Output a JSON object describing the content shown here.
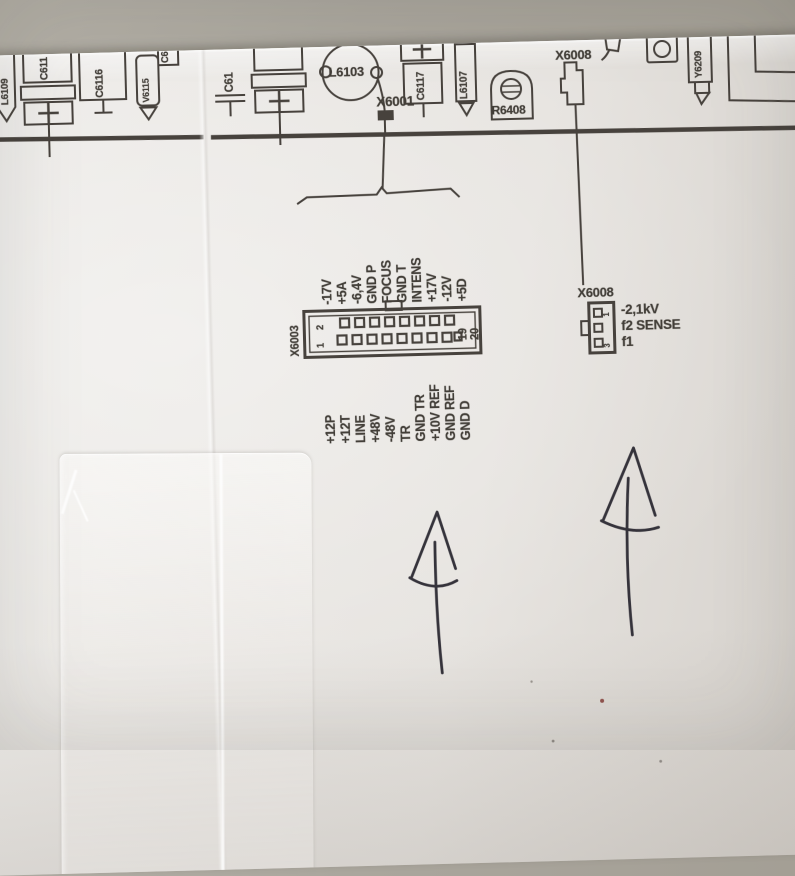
{
  "parts": {
    "l6109": "L6109",
    "c611": "C611",
    "c6116": "C6116",
    "v6115": "V6115",
    "c6_partial": "C6",
    "c61": "C61",
    "l6103": "L6103",
    "x6001": "X6001",
    "c6117": "C6117",
    "l6107": "L6107",
    "r6408": "R6408",
    "x6008_top": "X6008",
    "y6209": "Y6209"
  },
  "x6003": {
    "label": "X6003",
    "pins": {
      "top_left": "2",
      "bottom_left": "1",
      "right_inner": "19",
      "right_outer": "20"
    },
    "top_labels": [
      "-17V",
      "+5A",
      "-6,4V",
      "GND P",
      "FOCUS",
      "GND T",
      "INTENS",
      "+17V",
      "-12V",
      "+5D"
    ],
    "bottom_labels": [
      "+12P",
      "+12T",
      "LINE",
      "+48V",
      "-48V",
      "TR",
      "GND TR",
      "+10V REF",
      "GND REF",
      "GND D"
    ]
  },
  "x6008": {
    "label": "X6008",
    "pin_top": "1",
    "pin_bottom": "3",
    "line1": "-2,1kV",
    "line2": "f2 SENSE",
    "line3": "f1"
  },
  "colors": {
    "ink": "#47423d",
    "pen": "#35333b",
    "paper": "#e5e2de",
    "desk": "#a9a59c"
  }
}
